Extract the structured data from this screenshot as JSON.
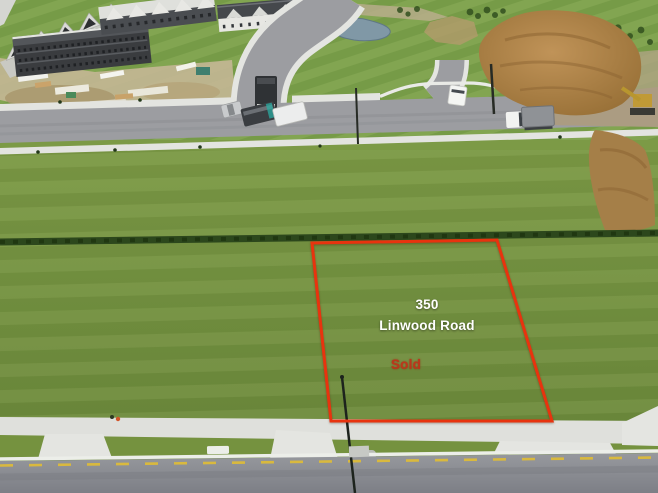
{
  "photo": {
    "kind": "aerial-drone-photo-of-vacant-lot",
    "labels": {
      "lot_number": "350",
      "road_name": "Linwood Road",
      "status": "Sold"
    },
    "colors": {
      "boundary_red": "#e8330e",
      "address_text": "#ffffff",
      "sold_text": "#c23018",
      "grass": "#75923f",
      "asphalt": "#9c9da1",
      "dirt": "#a8804a"
    }
  }
}
